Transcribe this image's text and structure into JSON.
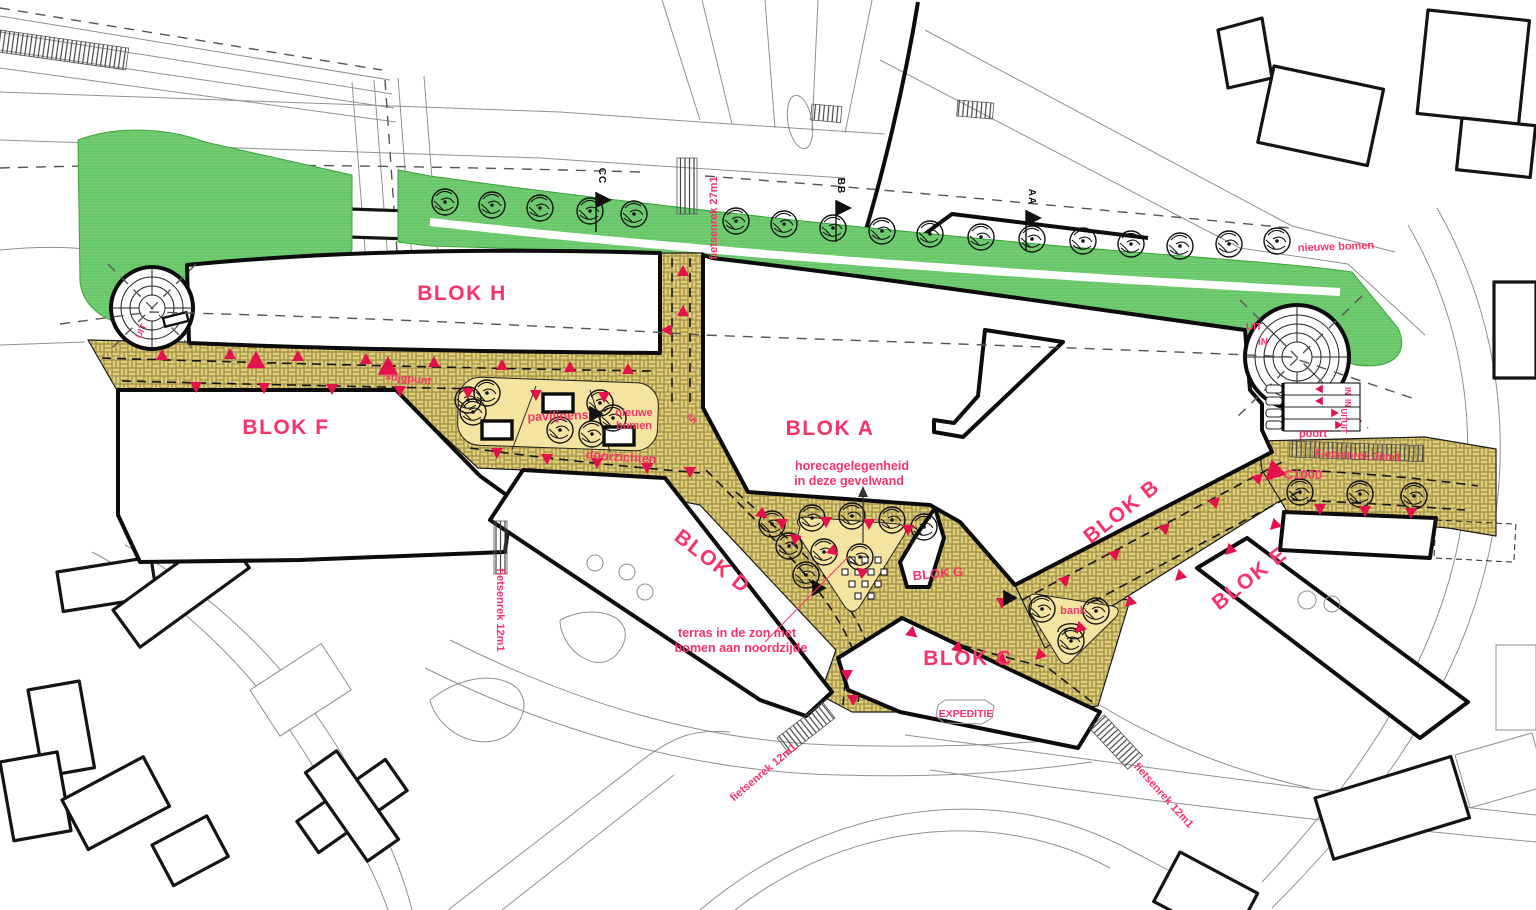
{
  "plan": {
    "type": "urban masterplan drawing",
    "blocks": {
      "h": "BLOK H",
      "f": "BLOK F",
      "a": "BLOK A",
      "d": "BLOK D",
      "g": "BLOK G",
      "c": "BLOK C",
      "b": "BLOK B",
      "e": "BLOK E"
    },
    "annotations": {
      "stijgpunt": "stijgpunt",
      "paviljoens": "paviljoens",
      "nieuwe_bomen_line1": "nieuwe",
      "nieuwe_bomen_line2": "bomen",
      "doorzichten": "doorzichten",
      "lift": "lift",
      "horeca_line1": "horecagelegenheid",
      "horeca_line2": "in deze gevelwand",
      "terras_line1": "terras in de zon met",
      "terras_line2": "bomen aan noordzijde",
      "bank": "bank",
      "expeditie": "EXPEDITIE",
      "poort": "poort",
      "c1000": "C1000",
      "nieuwe_bomen_noord": "nieuwe bomen",
      "uit": "UIT",
      "in": "IN"
    },
    "bike_racks": {
      "rack27": "fietsenrek 27m1",
      "rack12": "fietsenrek 12m1",
      "rack30": "Fietsenrek 30m1"
    },
    "sections": {
      "aa": "AA",
      "bb": "BB",
      "cc": "CC"
    },
    "colors": {
      "pink": "#F9336A",
      "marker": "#E3114C",
      "green": "#74CE74",
      "green_stripe": "#5FBE60",
      "paving": "#E0CD7A",
      "paving_line": "#94823B",
      "plaza": "#F5E4A0",
      "ink": "#111111",
      "context": "#909090"
    }
  }
}
